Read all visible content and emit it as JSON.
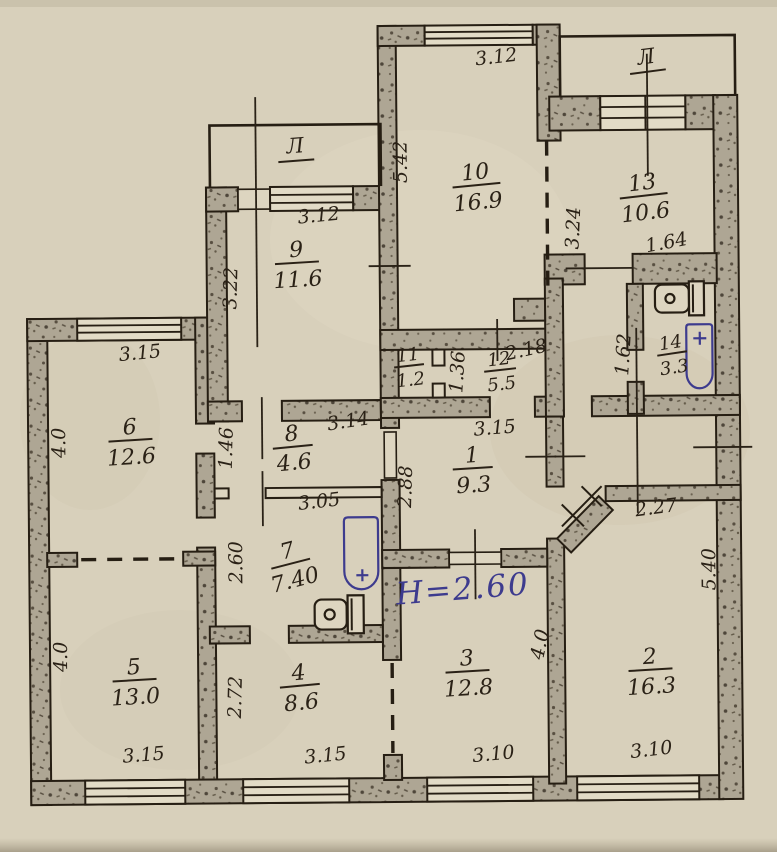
{
  "plan": {
    "annotation": {
      "text": "Н=2.60"
    },
    "colors": {
      "paper": "#d8d0bb",
      "ink": "#261e13",
      "wall_fill": "#aea694",
      "blue_ink": "#3d3b8e"
    },
    "balconies": [
      {
        "label": "Л"
      },
      {
        "label": "Л"
      }
    ],
    "rooms": [
      {
        "number": "10",
        "area": "16.9"
      },
      {
        "number": "13",
        "area": "10.6"
      },
      {
        "number": "9",
        "area": "11.6"
      },
      {
        "number": "6",
        "area": "12.6"
      },
      {
        "number": "11",
        "area": "1.2"
      },
      {
        "number": "12",
        "area": "5.5"
      },
      {
        "number": "14",
        "area": "3.3"
      },
      {
        "number": "8",
        "area": "4.6"
      },
      {
        "number": "1",
        "area": "9.3"
      },
      {
        "number": "7",
        "area": "7.40"
      },
      {
        "number": "5",
        "area": "13.0"
      },
      {
        "number": "4",
        "area": "8.6"
      },
      {
        "number": "3",
        "area": "12.8"
      },
      {
        "number": "2",
        "area": "16.3"
      }
    ],
    "dims": [
      {
        "text": "3.12"
      },
      {
        "text": "5.42"
      },
      {
        "text": "3.24"
      },
      {
        "text": "1.64"
      },
      {
        "text": "3.12"
      },
      {
        "text": "3.22"
      },
      {
        "text": "3.15"
      },
      {
        "text": "4.0"
      },
      {
        "text": "1.36"
      },
      {
        "text": "2.18"
      },
      {
        "text": "1.62"
      },
      {
        "text": "3.14"
      },
      {
        "text": "1.46"
      },
      {
        "text": "3.15"
      },
      {
        "text": "2.88"
      },
      {
        "text": "2.27"
      },
      {
        "text": "5.40"
      },
      {
        "text": "3.05"
      },
      {
        "text": "2.60"
      },
      {
        "text": "4.0"
      },
      {
        "text": "4.0"
      },
      {
        "text": "2.72"
      },
      {
        "text": "3.15"
      },
      {
        "text": "3.15"
      },
      {
        "text": "3.10"
      },
      {
        "text": "3.10"
      }
    ]
  }
}
